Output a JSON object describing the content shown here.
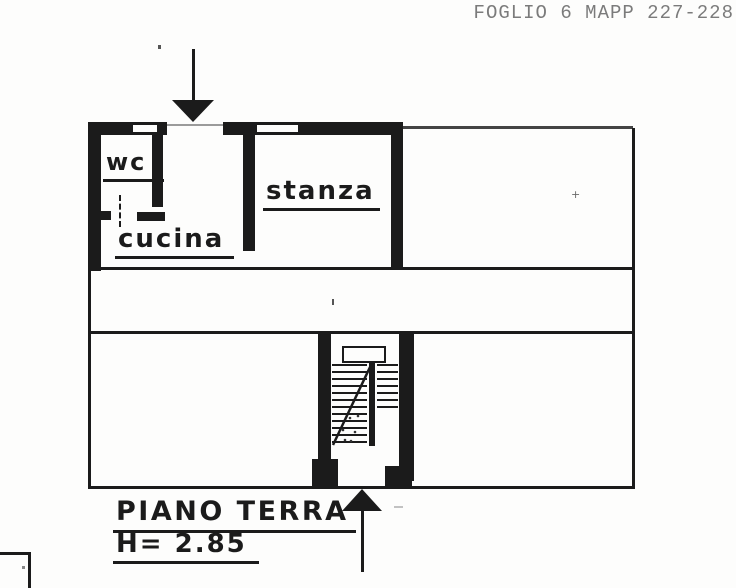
{
  "document": {
    "reference_header": "FOGLIO 6 MAPP 227-228",
    "floor_label": "PIANO TERRA",
    "floor_height": "H= 2.85",
    "rooms": {
      "wc": "wc",
      "kitchen": "cucina",
      "room": "stanza"
    },
    "colors": {
      "ink": "#1b1b1b",
      "faded_ink": "#6e6e6e",
      "paper": "#fdfdfc"
    }
  }
}
